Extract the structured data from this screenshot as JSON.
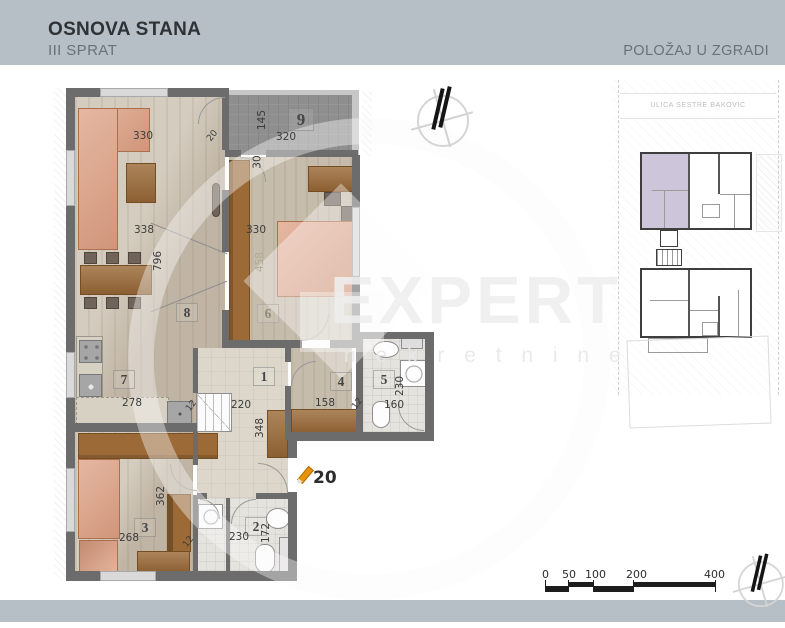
{
  "header": {
    "title": "OSNOVA STANA",
    "subtitle": "III SPRAT",
    "right_label": "POLOŽAJ U ZGRADI"
  },
  "watermark": {
    "brand": "EXPERT",
    "sub": "n e k r e t n i n e"
  },
  "site_plan": {
    "street": "ULICA SESTRE BAKOVIĆ"
  },
  "plan": {
    "unit_number": "20",
    "room_numbers": {
      "r1": "1",
      "r2": "2",
      "r3": "3",
      "r4": "4",
      "r5": "5",
      "r6": "6",
      "r7": "7",
      "r8": "8",
      "r9": "9"
    },
    "dims": {
      "living_top": "330",
      "living_door": "20",
      "terrace_depth": "145",
      "terrace_width": "320",
      "terrace_door": "30",
      "living_width": "338",
      "living_len": "796",
      "bed6_width": "330",
      "bed6_len": "458",
      "kitchen_width": "278",
      "hall_width": "220",
      "hall_len": "348",
      "room4_width": "158",
      "bath5_len": "230",
      "bath5_width": "160",
      "room3_len": "362",
      "room3_width": "268",
      "bath2_width": "230",
      "bath2_len": "172",
      "wall_a": "12",
      "wall_b": "12",
      "wall_c": "12"
    }
  },
  "scale_bar": {
    "labels": [
      "0",
      "50",
      "100",
      "200",
      "400"
    ]
  },
  "colors": {
    "header_band": "#b6bfc5",
    "highlight_unit": "#cdc5da",
    "pencil_accent": "#e8930c",
    "terrace_floor": "#8f8f8f",
    "sofa": "#dd9f82",
    "wood_furniture": "#9b6a37",
    "wall": "#6c6c6c"
  }
}
